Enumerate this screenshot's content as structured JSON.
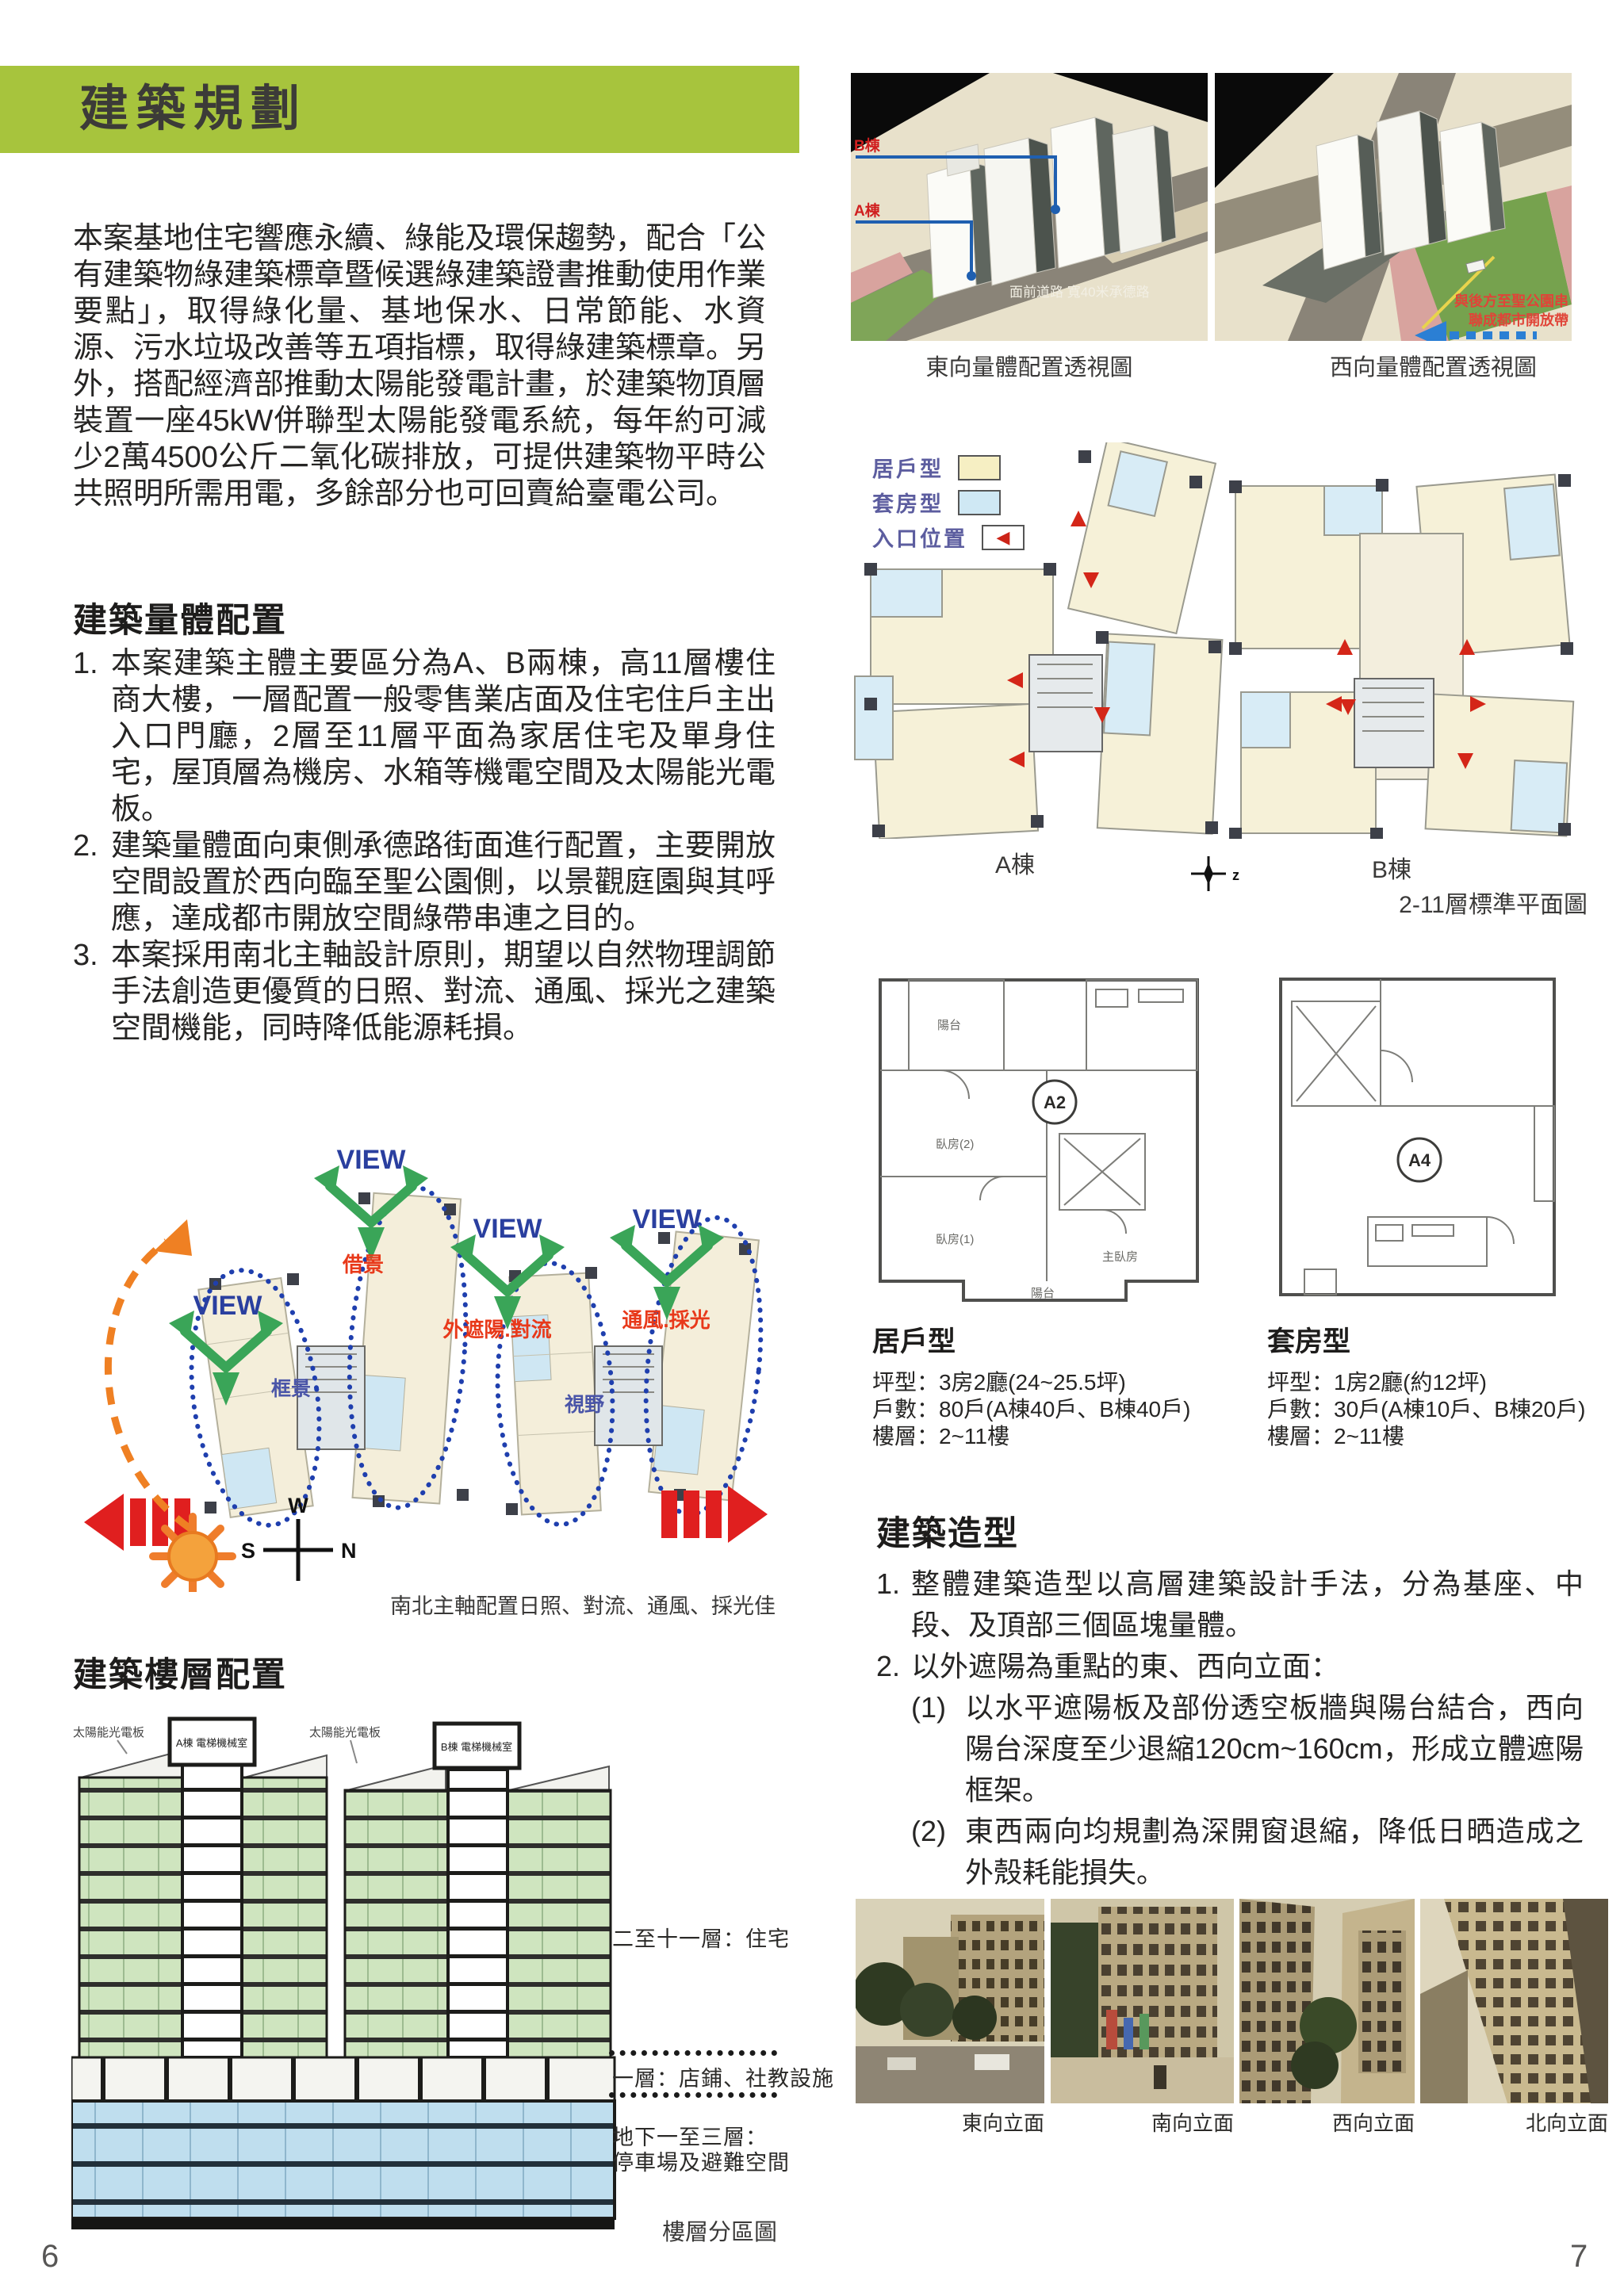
{
  "colors": {
    "banner_green": "#a7c43d",
    "legend_text_purple": "#5c5d9f",
    "unit_cream": "#f6efc3",
    "suite_blue": "#cfe8f4",
    "entry_red": "#cc2418",
    "view_label_blue": "#2a3f9f",
    "diagram_arrow_green": "#3aa558",
    "annotation_red": "#e8391a",
    "section_floor_green": "#cfe5bf",
    "section_basement_blue": "#bfdeee"
  },
  "icons": {
    "entry_arrow_glyph": "◀"
  },
  "left_page": {
    "banner_title": "建築規劃",
    "intro": "本案基地住宅響應永續、綠能及環保趨勢，配合「公有建築物綠建築標章暨候選綠建築證書推動使用作業要點」，取得綠化量、基地保水、日常節能、水資源、污水垃圾改善等五項指標，取得綠建築標章。另外，搭配經濟部推動太陽能發電計畫，於建築物頂層裝置一座45kW併聯型太陽能發電系統，每年約可減少2萬4500公斤二氧化碳排放，可提供建築物平時公共照明所需用電，多餘部分也可回賣給臺電公司。",
    "massing": {
      "heading": "建築量體配置",
      "items": [
        {
          "num": "1.",
          "text": "本案建築主體主要區分為A、B兩棟，高11層樓住商大樓，一層配置一般零售業店面及住宅住戶主出入口門廳，2層至11層平面為家居住宅及單身住宅，屋頂層為機房、水箱等機電空間及太陽能光電板。"
        },
        {
          "num": "2.",
          "text": "建築量體面向東側承德路街面進行配置，主要開放空間設置於西向臨至聖公園側，以景觀庭園與其呼應，達成都市開放空間綠帶串連之目的。"
        },
        {
          "num": "3.",
          "text": "本案採用南北主軸設計原則，期望以自然物理調節手法創造更優質的日照、對流、通風、採光之建築空間機能，同時降低能源耗損。"
        }
      ]
    },
    "view_diagram": {
      "view": "VIEW",
      "borrow": "借景",
      "frame": "框景",
      "shade_convection": "外遮陽.對流",
      "vent_light": "通風.採光",
      "vista": "視野",
      "compass": {
        "w": "W",
        "s": "S",
        "n": "N",
        "e": "E"
      },
      "caption": "南北主軸配置日照、對流、通風、採光佳"
    },
    "floors_section": {
      "heading": "建築樓層配置",
      "solar_label": "太陽能光電板",
      "tower_a_room": "A棟 電梯機械室",
      "tower_b_room": "B棟 電梯機械室",
      "label_upper": "二至十一層：住宅",
      "label_ground": "一層：店鋪、社教設施",
      "label_basement_1": "地下一至三層：",
      "label_basement_2": "停車場及避難空間",
      "caption": "樓層分區圖"
    },
    "page_number": "6"
  },
  "right_page": {
    "render_east": {
      "b_label": "B棟",
      "a_label": "A棟",
      "road_label": "面前道路  寬40米承德路",
      "caption": "東向量體配置透視圖"
    },
    "render_west": {
      "note_line1": "與後方至聖公園串",
      "note_line2": "聯成都市開放帶",
      "caption": "西向量體配置透視圖"
    },
    "legend": {
      "unit": "居戶型",
      "suite": "套房型",
      "entry": "入口位置"
    },
    "plans": {
      "a_label": "A棟",
      "b_label": "B棟",
      "compass": "z",
      "caption": "2-11層標準平面圖"
    },
    "unit_detail": {
      "name": "居戶型",
      "plan_label": "A2",
      "rooms": {
        "balcony_top": "陽台",
        "bed2": "臥房(2)",
        "bed1": "臥房(1)",
        "master": "主臥房",
        "balcony": "陽台"
      },
      "size": "坪型：3房2廳(24~25.5坪)",
      "count": "戶數：80戶(A棟40戶、B棟40戶)",
      "floors": "樓層：2~11樓"
    },
    "suite_detail": {
      "name": "套房型",
      "plan_label": "A4",
      "size": "坪型：1房2廳(約12坪)",
      "count": "戶數：30戶(A棟10戶、B棟20戶)",
      "floors": "樓層：2~11樓"
    },
    "styling": {
      "heading": "建築造型",
      "items": [
        {
          "num": "1.",
          "text": "整體建築造型以高層建築設計手法，分為基座、中段、及頂部三個區塊量體。"
        },
        {
          "num": "2.",
          "text": "以外遮陽為重點的東、西向立面："
        }
      ],
      "subitems": [
        {
          "num": "(1)",
          "text": "以水平遮陽板及部份透空板牆與陽台結合，西向陽台深度至少退縮120cm~160cm，形成立體遮陽框架。"
        },
        {
          "num": "(2)",
          "text": "東西兩向均規劃為深開窗退縮，降低日晒造成之外殼耗能損失。"
        }
      ]
    },
    "photos": [
      {
        "caption": "東向立面"
      },
      {
        "caption": "南向立面"
      },
      {
        "caption": "西向立面"
      },
      {
        "caption": "北向立面"
      }
    ],
    "page_number": "7"
  }
}
